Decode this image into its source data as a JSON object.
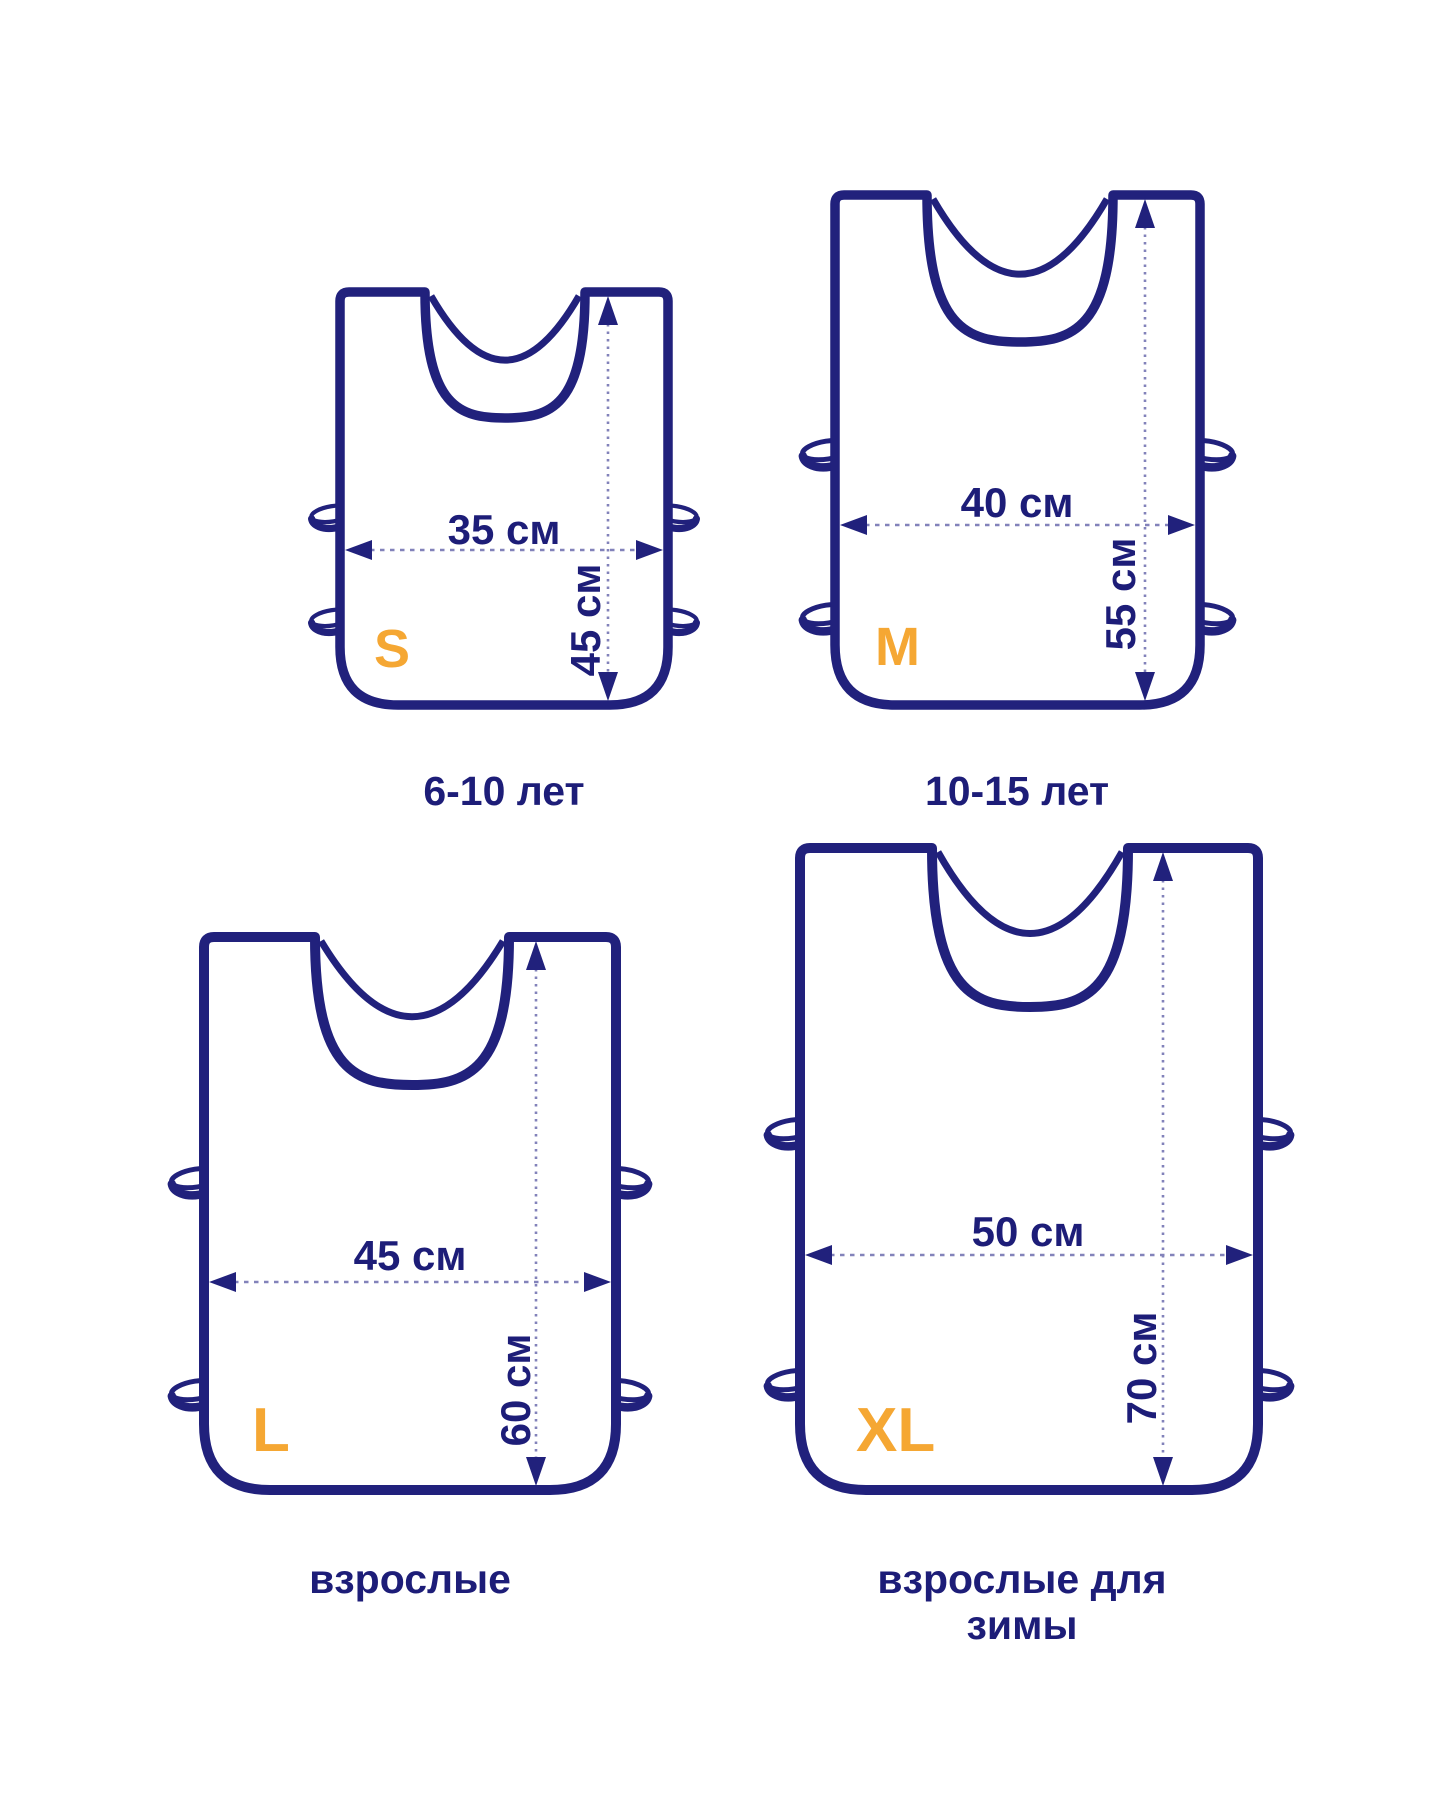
{
  "palette": {
    "navy": "#21217c",
    "orange": "#f5a733",
    "dim_line": "#8282ba",
    "background": "#ffffff"
  },
  "unit": "см",
  "sizes": [
    {
      "code": "S",
      "width_label": "35 см",
      "height_label": "45 см",
      "caption": "6-10 лет"
    },
    {
      "code": "M",
      "width_label": "40 см",
      "height_label": "55 см",
      "caption": "10-15 лет"
    },
    {
      "code": "L",
      "width_label": "45 см",
      "height_label": "60 см",
      "caption": "взрослые"
    },
    {
      "code": "XL",
      "width_label": "50 см",
      "height_label": "70 см",
      "caption": "взрослые для зимы"
    }
  ]
}
